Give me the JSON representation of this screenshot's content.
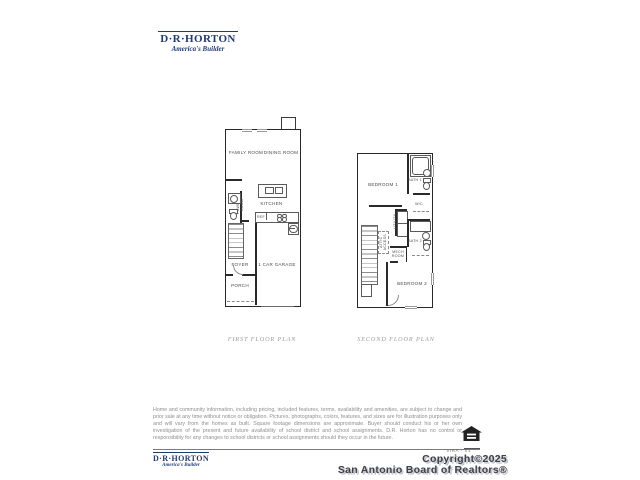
{
  "brand": {
    "name": "D·R·HORTON",
    "tagline": "America's Builder",
    "color": "#233a72"
  },
  "first_floor": {
    "caption": "FIRST FLOOR PLAN",
    "labels": {
      "family_room": "FAMILY ROOM",
      "dining_room": "DINING ROOM",
      "kitchen": "KITCHEN",
      "ref": "REF",
      "powder_room": "POWDER\nROOM",
      "foyer": "FOYER",
      "garage": "1 CAR GARAGE",
      "porch": "PORCH"
    }
  },
  "second_floor": {
    "caption": "SECOND FLOOR PLAN",
    "labels": {
      "bedroom_1": "BEDROOM 1",
      "bath_1": "BATH 1",
      "wc": "W/C",
      "utility": "UTILITY",
      "attic_access": "ATTIC\nACCESS",
      "bath_2": "BATH 2",
      "mech_room": "MECH\nROOM",
      "bedroom_2": "BEDROOM 2"
    }
  },
  "disclaimer": "Home and community information, including pricing, included features, terms, availability and amenities, are subject to change and prior sale at any time without notice or obligation. Pictures, photographs, colors, features, and sizes are for illustration purposes only and will vary from the homes as built. Square footage dimensions are approximate. Buyer should conduct his or her own investigation of the present and future availability of school district and school assignments. D.R. Horton has no control or responsibility for any changes to school districts or school assignments should they occur in the future.",
  "footer": {
    "plan_code": "VIRA - V1",
    "copyright": "Copyright©2025",
    "attribution": "San Antonio Board of Realtors®",
    "icons": {
      "equal_housing": "equal-housing-logo"
    }
  }
}
